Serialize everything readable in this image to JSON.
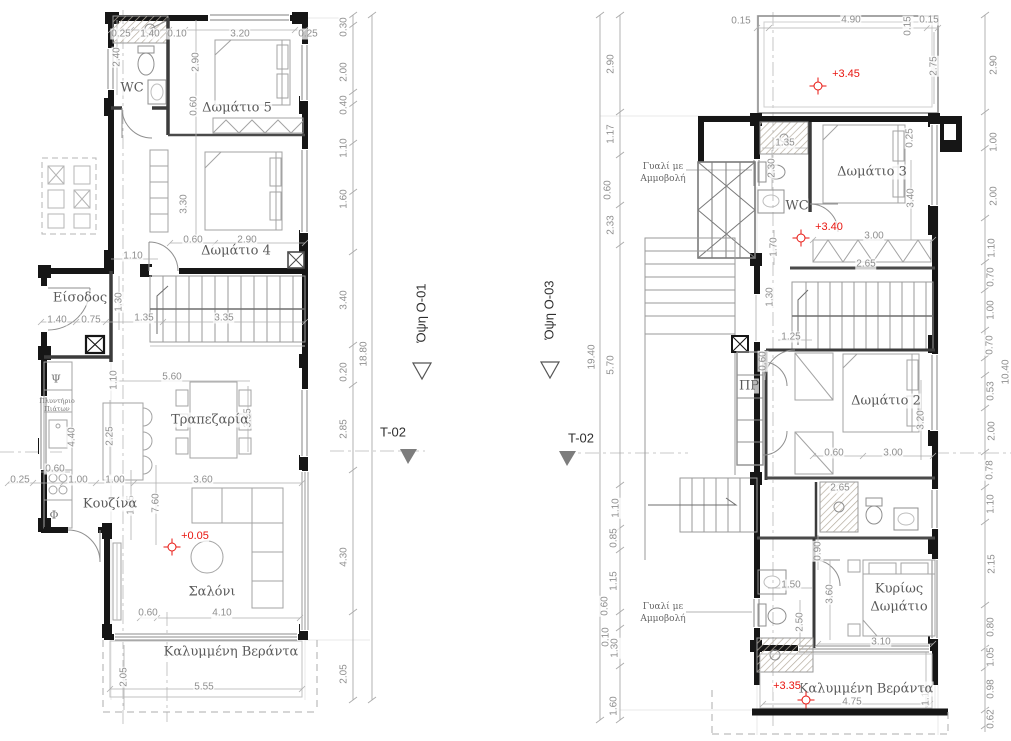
{
  "drawing": {
    "kind": "architectural floor plans (two storeys, Greek annotations)",
    "colors": {
      "wall": "#161616",
      "line_medium": "#8f8f8f",
      "line_light": "#c4c4c4",
      "dim_text": "#8f8f8f",
      "elevation_red": "#e8150f",
      "section_grey": "#7d7d7d"
    }
  },
  "text_layers": [
    {
      "name": "dimension",
      "class": "dim",
      "items": [
        {
          "t": "0.25",
          "x": 121,
          "y": 34
        },
        {
          "t": "1.40",
          "x": 150,
          "y": 34
        },
        {
          "t": "0.10",
          "x": 177,
          "y": 34
        },
        {
          "t": "3.20",
          "x": 240,
          "y": 34
        },
        {
          "t": "0.25",
          "x": 308,
          "y": 34
        },
        {
          "t": "2.40",
          "x": 117,
          "y": 57,
          "r": 1
        },
        {
          "t": "2.90",
          "x": 196,
          "y": 62,
          "r": 1
        },
        {
          "t": "0.60",
          "x": 194,
          "y": 106,
          "r": 1
        },
        {
          "t": "3.30",
          "x": 184,
          "y": 204,
          "r": 1
        },
        {
          "t": "0.60",
          "x": 193,
          "y": 240
        },
        {
          "t": "2.90",
          "x": 247,
          "y": 240
        },
        {
          "t": "1.10",
          "x": 133,
          "y": 256
        },
        {
          "t": "1.30",
          "x": 119,
          "y": 302,
          "r": 1
        },
        {
          "t": "1.40",
          "x": 57,
          "y": 320
        },
        {
          "t": "0.75",
          "x": 91,
          "y": 320
        },
        {
          "t": "1.35",
          "x": 144,
          "y": 318
        },
        {
          "t": "3.35",
          "x": 224,
          "y": 318
        },
        {
          "t": "1.10",
          "x": 114,
          "y": 380,
          "r": 1
        },
        {
          "t": "5.60",
          "x": 172,
          "y": 377
        },
        {
          "t": "3.55",
          "x": 248,
          "y": 418,
          "r": 1
        },
        {
          "t": "4.40",
          "x": 72,
          "y": 437,
          "r": 1
        },
        {
          "t": "2.25",
          "x": 110,
          "y": 436,
          "r": 1
        },
        {
          "t": "0.60",
          "x": 55,
          "y": 469
        },
        {
          "t": "0.25",
          "x": 20,
          "y": 480
        },
        {
          "t": "1.00",
          "x": 78,
          "y": 480
        },
        {
          "t": "1.00",
          "x": 115,
          "y": 480
        },
        {
          "t": "3.60",
          "x": 203,
          "y": 480
        },
        {
          "t": "1.05",
          "x": 131,
          "y": 505,
          "r": 1
        },
        {
          "t": "7.60",
          "x": 156,
          "y": 503,
          "r": 1
        },
        {
          "t": "0.60",
          "x": 148,
          "y": 613
        },
        {
          "t": "4.10",
          "x": 222,
          "y": 613
        },
        {
          "t": "2.05",
          "x": 124,
          "y": 677,
          "r": 1
        },
        {
          "t": "5.55",
          "x": 204,
          "y": 687
        },
        {
          "t": "0.30",
          "x": 344,
          "y": 27,
          "r": 1
        },
        {
          "t": "2.00",
          "x": 344,
          "y": 72,
          "r": 1
        },
        {
          "t": "0.40",
          "x": 344,
          "y": 105,
          "r": 1
        },
        {
          "t": "1.10",
          "x": 344,
          "y": 148,
          "r": 1
        },
        {
          "t": "1.60",
          "x": 344,
          "y": 199,
          "r": 1
        },
        {
          "t": "3.40",
          "x": 344,
          "y": 300,
          "r": 1
        },
        {
          "t": "18.80",
          "x": 364,
          "y": 354,
          "r": 1
        },
        {
          "t": "0.20",
          "x": 344,
          "y": 372,
          "r": 1
        },
        {
          "t": "2.85",
          "x": 344,
          "y": 429,
          "r": 1
        },
        {
          "t": "4.30",
          "x": 344,
          "y": 557,
          "r": 1
        },
        {
          "t": "2.05",
          "x": 344,
          "y": 674,
          "r": 1
        },
        {
          "t": "2.90",
          "x": 611,
          "y": 64,
          "r": 1
        },
        {
          "t": "1.17",
          "x": 611,
          "y": 134,
          "r": 1
        },
        {
          "t": "0.60",
          "x": 608,
          "y": 190,
          "r": 1
        },
        {
          "t": "2.33",
          "x": 611,
          "y": 225,
          "r": 1
        },
        {
          "t": "19.40",
          "x": 592,
          "y": 357,
          "r": 1
        },
        {
          "t": "5.70",
          "x": 611,
          "y": 365,
          "r": 1
        },
        {
          "t": "1.10",
          "x": 616,
          "y": 508,
          "r": 1
        },
        {
          "t": "0.85",
          "x": 614,
          "y": 538,
          "r": 1
        },
        {
          "t": "1.15",
          "x": 614,
          "y": 581,
          "r": 1
        },
        {
          "t": "0.60",
          "x": 605,
          "y": 606,
          "r": 1
        },
        {
          "t": "0.10",
          "x": 606,
          "y": 637,
          "r": 1
        },
        {
          "t": "1.30",
          "x": 615,
          "y": 648,
          "r": 1
        },
        {
          "t": "1.60",
          "x": 614,
          "y": 706,
          "r": 1
        },
        {
          "t": "0.15",
          "x": 741,
          "y": 21
        },
        {
          "t": "4.90",
          "x": 851,
          "y": 20
        },
        {
          "t": "0.15",
          "x": 908,
          "y": 26,
          "r": 1
        },
        {
          "t": "0.15",
          "x": 929,
          "y": 20
        },
        {
          "t": "2.75",
          "x": 934,
          "y": 66,
          "r": 1
        },
        {
          "t": "0.25",
          "x": 910,
          "y": 138,
          "r": 1
        },
        {
          "t": "1.35",
          "x": 785,
          "y": 143
        },
        {
          "t": "2.30",
          "x": 772,
          "y": 168,
          "r": 1
        },
        {
          "t": "3.40",
          "x": 911,
          "y": 198,
          "r": 1
        },
        {
          "t": "3.00",
          "x": 874,
          "y": 236
        },
        {
          "t": "1.70",
          "x": 774,
          "y": 247,
          "r": 1
        },
        {
          "t": "2.65",
          "x": 866,
          "y": 264
        },
        {
          "t": "1.30",
          "x": 770,
          "y": 297,
          "r": 1
        },
        {
          "t": "1.25",
          "x": 791,
          "y": 337
        },
        {
          "t": "0.60",
          "x": 763,
          "y": 361,
          "r": 1
        },
        {
          "t": "3.20",
          "x": 921,
          "y": 420,
          "r": 1
        },
        {
          "t": "0.60",
          "x": 834,
          "y": 453
        },
        {
          "t": "3.00",
          "x": 893,
          "y": 453
        },
        {
          "t": "2.65",
          "x": 840,
          "y": 488
        },
        {
          "t": "0.90",
          "x": 818,
          "y": 551,
          "r": 1
        },
        {
          "t": "1.50",
          "x": 791,
          "y": 585
        },
        {
          "t": "2.50",
          "x": 800,
          "y": 622,
          "r": 1
        },
        {
          "t": "3.60",
          "x": 830,
          "y": 594,
          "r": 1
        },
        {
          "t": "3.10",
          "x": 881,
          "y": 642
        },
        {
          "t": "4.75",
          "x": 852,
          "y": 702
        },
        {
          "t": "1.10",
          "x": 926,
          "y": 696,
          "r": 1
        },
        {
          "t": "2.90",
          "x": 994,
          "y": 65,
          "r": 1
        },
        {
          "t": "1.00",
          "x": 994,
          "y": 142,
          "r": 1
        },
        {
          "t": "2.00",
          "x": 994,
          "y": 196,
          "r": 1
        },
        {
          "t": "1.10",
          "x": 992,
          "y": 248,
          "r": 1
        },
        {
          "t": "0.70",
          "x": 991,
          "y": 277,
          "r": 1
        },
        {
          "t": "1.00",
          "x": 991,
          "y": 310,
          "r": 1
        },
        {
          "t": "0.70",
          "x": 990,
          "y": 345,
          "r": 1
        },
        {
          "t": "10.40",
          "x": 1006,
          "y": 372,
          "r": 1
        },
        {
          "t": "0.53",
          "x": 991,
          "y": 391,
          "r": 1
        },
        {
          "t": "2.00",
          "x": 992,
          "y": 431,
          "r": 1
        },
        {
          "t": "0.78",
          "x": 990,
          "y": 470,
          "r": 1
        },
        {
          "t": "1.10",
          "x": 991,
          "y": 504,
          "r": 1
        },
        {
          "t": "2.15",
          "x": 992,
          "y": 564,
          "r": 1
        },
        {
          "t": "0.80",
          "x": 991,
          "y": 627,
          "r": 1
        },
        {
          "t": "1.05",
          "x": 991,
          "y": 657,
          "r": 1
        },
        {
          "t": "0.98",
          "x": 991,
          "y": 689,
          "r": 1
        },
        {
          "t": "0.62",
          "x": 991,
          "y": 719,
          "r": 1
        }
      ]
    },
    {
      "name": "room",
      "class": "room",
      "items": [
        {
          "t": "WC",
          "x": 132,
          "y": 88
        },
        {
          "t": "Δωμάτιο 5",
          "x": 237,
          "y": 108
        },
        {
          "t": "Δωμάτιο 4",
          "x": 236,
          "y": 251
        },
        {
          "t": "Είσοδος",
          "x": 80,
          "y": 298
        },
        {
          "t": "Τραπεζαρία",
          "x": 210,
          "y": 420
        },
        {
          "t": "Κουζίνα",
          "x": 110,
          "y": 504
        },
        {
          "t": "Σαλόνι",
          "x": 212,
          "y": 592
        },
        {
          "t": "Καλυμμένη Βεράντα",
          "x": 231,
          "y": 652
        },
        {
          "t": "Δωμάτιο 3",
          "x": 872,
          "y": 172
        },
        {
          "t": "WC",
          "x": 797,
          "y": 206
        },
        {
          "t": "ΠΡ",
          "x": 749,
          "y": 386
        },
        {
          "t": "Δωμάτιο 2",
          "x": 886,
          "y": 401
        },
        {
          "t": "Κυρίως",
          "x": 899,
          "y": 589
        },
        {
          "t": "Δωμάτιο",
          "x": 899,
          "y": 607
        },
        {
          "t": "Καλυμμένη Βεράντα",
          "x": 866,
          "y": 689
        }
      ]
    },
    {
      "name": "appliance",
      "class": "tiny",
      "items": [
        {
          "t": "Ψ",
          "x": 56,
          "y": 379,
          "fs": 11
        },
        {
          "t": "Πλυντήριο",
          "x": 57,
          "y": 401
        },
        {
          "t": "Πιάτων",
          "x": 57,
          "y": 409
        },
        {
          "t": "Φ",
          "x": 54,
          "y": 515,
          "fs": 11
        }
      ]
    },
    {
      "name": "annotation",
      "class": "anno",
      "items": [
        {
          "t": "Γυαλί με",
          "x": 663,
          "y": 167
        },
        {
          "t": "Αμμοβολή",
          "x": 663,
          "y": 179
        },
        {
          "t": "Γυαλί με",
          "x": 663,
          "y": 607
        },
        {
          "t": "Αμμοβολή",
          "x": 663,
          "y": 619
        }
      ]
    },
    {
      "name": "elevation",
      "class": "elev",
      "items": [
        {
          "t": "+0.05",
          "x": 195,
          "y": 536
        },
        {
          "t": "+3.45",
          "x": 846,
          "y": 74
        },
        {
          "t": "+3.40",
          "x": 829,
          "y": 227
        },
        {
          "t": "+3.35",
          "x": 787,
          "y": 686
        }
      ]
    },
    {
      "name": "section",
      "class": "section",
      "items": [
        {
          "t": "Όψη Ο-01",
          "x": 421,
          "y": 313,
          "r": 1
        },
        {
          "t": "T-02",
          "x": 393,
          "y": 432
        },
        {
          "t": "Όψη Ο-03",
          "x": 549,
          "y": 310,
          "r": 1
        },
        {
          "t": "T-02",
          "x": 581,
          "y": 438
        }
      ]
    }
  ],
  "elevation_markers": [
    {
      "x": 172,
      "y": 547
    },
    {
      "x": 818,
      "y": 86
    },
    {
      "x": 801,
      "y": 238
    },
    {
      "x": 806,
      "y": 700
    }
  ]
}
